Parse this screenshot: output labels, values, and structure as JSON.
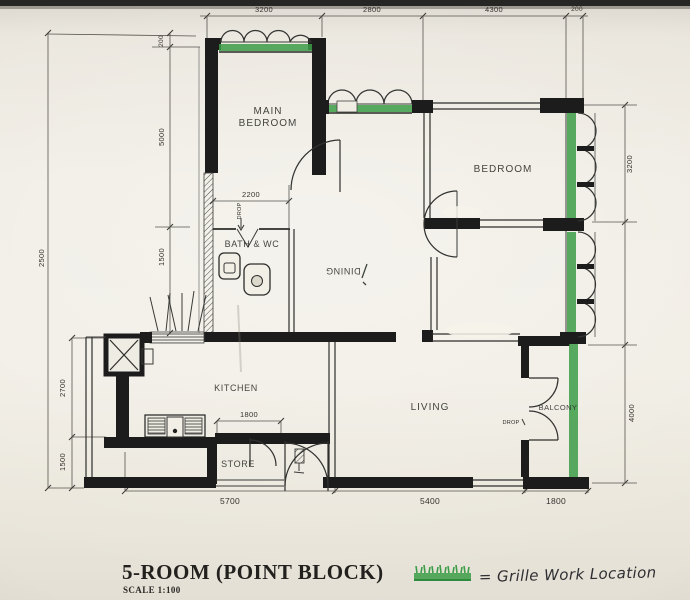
{
  "plan": {
    "rooms": {
      "main_bedroom": {
        "line1": "MAIN",
        "line2": "BEDROOM"
      },
      "bedroom": "BEDROOM",
      "bath_wc": "BATH & WC",
      "dining": "DINING",
      "kitchen": "KITCHEN",
      "living": "LIVING",
      "balcony": "BALCONY",
      "store": "STORE"
    },
    "annotations": {
      "drop_bath": "DROP",
      "drop_balcony": "DROP"
    },
    "dimensions": {
      "top": [
        "3200",
        "2800",
        "4300",
        "200"
      ],
      "left_outer": "2500",
      "left_inner": [
        "200",
        "5000",
        "1500"
      ],
      "left_lower": [
        "2700",
        "1500"
      ],
      "right": [
        "3200",
        "4000"
      ],
      "bottom": [
        "5700",
        "5400",
        "1800"
      ],
      "main_bedroom_inner": "2200",
      "kitchen_inner": "1800"
    }
  },
  "title_block": {
    "title": "5-ROOM (POINT BLOCK)",
    "scale": "SCALE 1:100"
  },
  "legend": {
    "text": "= Grille Work Location",
    "grille_color": "#3c9c47"
  }
}
